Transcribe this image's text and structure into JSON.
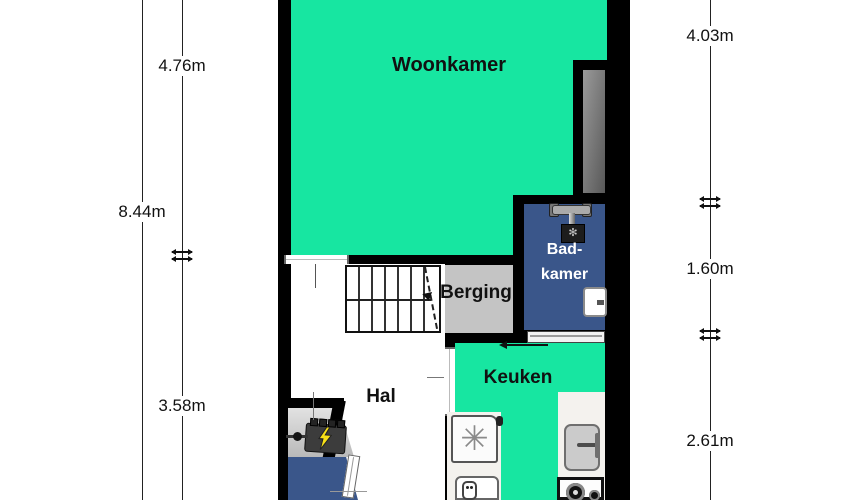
{
  "rooms": {
    "woonkamer": {
      "label": "Woonkamer"
    },
    "badkamer": {
      "line1": "Bad-",
      "line2": "kamer"
    },
    "berging": {
      "label": "Berging"
    },
    "keuken": {
      "label": "Keuken"
    },
    "hal": {
      "label": "Hal"
    }
  },
  "dimensions": {
    "left_total": "8.44m",
    "left_top": "4.76m",
    "left_bottom": "3.58m",
    "right_top": "4.03m",
    "right_middle": "1.60m",
    "right_bottom": "2.61m"
  },
  "glyphs": {
    "fan": "✳",
    "shower_spray": "✻"
  },
  "colors": {
    "living_green": "#17E6A1",
    "wet_room_blue": "#3A568A",
    "storage_gray": "#C4C4C4",
    "wall_black": "#000000",
    "bolt_yellow": "#F7E017"
  }
}
